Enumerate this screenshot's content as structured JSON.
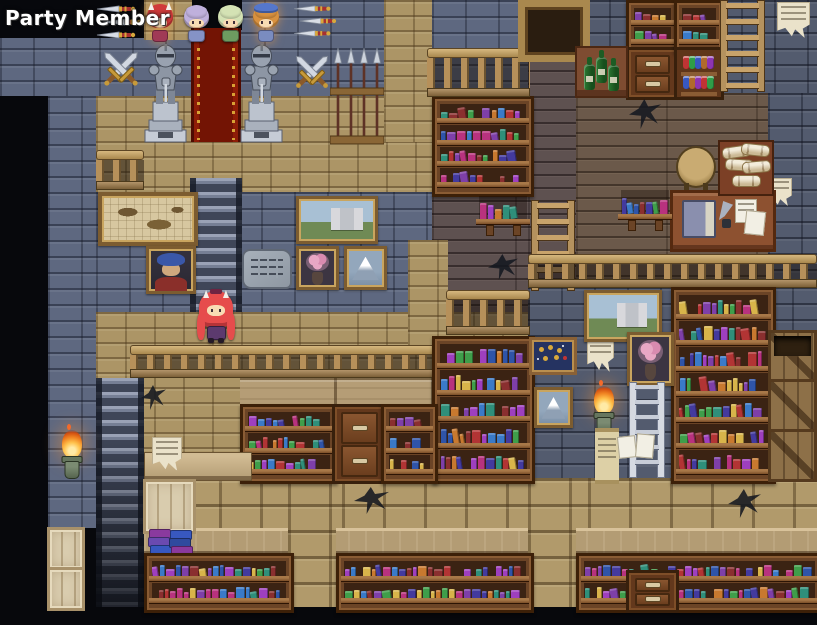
{
  "screen": {
    "width": 817,
    "height": 625
  },
  "hud": {
    "party_label": "Party Member"
  },
  "palette": {
    "books": [
      "#b23434",
      "#2f54a8",
      "#7e3fa8",
      "#2f8f7a",
      "#c8792f",
      "#b8327e",
      "#3a7ac8",
      "#8a2f2f",
      "#d8b44a",
      "#433a9e",
      "#3f9e4a",
      "#9e3fbe"
    ],
    "potions": [
      "#c03434",
      "#2f9e48",
      "#3858c0",
      "#b06a2c",
      "#8e34b0"
    ],
    "accent_gold": "#c79a3a",
    "carpet_red": "#8e1d07",
    "flame_orange": "#f08422",
    "stone_blue": "#5e6880",
    "stone_tan": "#ac9566",
    "wood_plank": "#5e5150",
    "wood_counter": "#b39c74"
  },
  "map": {
    "regions": [
      {
        "t": "blue",
        "x": 0,
        "y": 0,
        "w": 432,
        "h": 96
      },
      {
        "t": "blue",
        "x": 432,
        "y": 0,
        "w": 96,
        "h": 96
      },
      {
        "t": "blueD",
        "x": 576,
        "y": 0,
        "w": 241,
        "h": 93
      },
      {
        "t": "tan",
        "x": 144,
        "y": 0,
        "w": 48,
        "h": 40
      },
      {
        "t": "tan",
        "x": 96,
        "y": 96,
        "w": 336,
        "h": 96
      },
      {
        "t": "tan",
        "x": 384,
        "y": 0,
        "w": 48,
        "h": 142
      },
      {
        "t": "blue",
        "x": 96,
        "y": 192,
        "w": 336,
        "h": 120
      },
      {
        "t": "blue",
        "x": 48,
        "y": 96,
        "w": 48,
        "h": 432
      },
      {
        "t": "tan",
        "x": 96,
        "y": 312,
        "w": 432,
        "h": 166
      },
      {
        "t": "plank",
        "x": 432,
        "y": 96,
        "w": 96,
        "h": 216
      },
      {
        "t": "plank",
        "x": 528,
        "y": 44,
        "w": 48,
        "h": 268
      },
      {
        "t": "plankL",
        "x": 576,
        "y": 93,
        "w": 192,
        "h": 194
      },
      {
        "t": "blueD",
        "x": 768,
        "y": 93,
        "w": 49,
        "h": 194
      },
      {
        "t": "blueD",
        "x": 528,
        "y": 287,
        "w": 289,
        "h": 191
      },
      {
        "t": "tan",
        "x": 408,
        "y": 240,
        "w": 40,
        "h": 112
      },
      {
        "t": "tanblock",
        "x": 96,
        "y": 478,
        "w": 721,
        "h": 50
      },
      {
        "t": "counter",
        "x": 144,
        "y": 528,
        "w": 673,
        "h": 26
      },
      {
        "t": "tanblock",
        "x": 288,
        "y": 478,
        "w": 48,
        "h": 129
      },
      {
        "t": "tanblock",
        "x": 528,
        "y": 478,
        "w": 48,
        "h": 129
      },
      {
        "t": "panel",
        "x": 240,
        "y": 378,
        "w": 288,
        "h": 30
      },
      {
        "t": "black",
        "x": 192,
        "y": 0,
        "w": 50,
        "h": 30
      },
      {
        "t": "black",
        "x": 0,
        "y": 96,
        "w": 48,
        "h": 529
      },
      {
        "t": "black",
        "x": 0,
        "y": 607,
        "w": 817,
        "h": 18
      },
      {
        "t": "black",
        "x": 0,
        "y": 0,
        "w": 144,
        "h": 38
      }
    ],
    "objects": [
      {
        "t": "stairs",
        "n": "staircase-upper",
        "x": 190,
        "y": 178,
        "w": 52,
        "h": 134
      },
      {
        "t": "stairs",
        "n": "staircase-lower",
        "x": 96,
        "y": 378,
        "w": 48,
        "h": 229,
        "v": "fade"
      },
      {
        "t": "carpet",
        "n": "red-carpet",
        "x": 191,
        "y": 28,
        "w": 50,
        "h": 114
      },
      {
        "t": "swords",
        "n": "crossed-swords",
        "x": 97,
        "y": 46,
        "w": 48,
        "h": 46
      },
      {
        "t": "swords",
        "n": "crossed-swords",
        "x": 289,
        "y": 50,
        "w": 46,
        "h": 44
      },
      {
        "t": "daggers",
        "n": "throwing-knives",
        "x": 95,
        "y": 3,
        "w": 50,
        "h": 40
      },
      {
        "t": "daggers",
        "n": "throwing-knives",
        "x": 292,
        "y": 3,
        "w": 48,
        "h": 38
      },
      {
        "t": "statue",
        "n": "armor-statue",
        "x": 141,
        "y": 40,
        "w": 49,
        "h": 104
      },
      {
        "t": "statue",
        "n": "armor-statue",
        "x": 237,
        "y": 40,
        "w": 49,
        "h": 104
      },
      {
        "t": "spears",
        "n": "spear-rack",
        "x": 330,
        "y": 46,
        "w": 54,
        "h": 100
      },
      {
        "t": "railing",
        "n": "mezzanine-railing",
        "x": 96,
        "y": 150,
        "w": 48,
        "h": 40
      },
      {
        "t": "painting",
        "v": "map",
        "n": "wall-map",
        "x": 98,
        "y": 192,
        "w": 92,
        "h": 46
      },
      {
        "t": "painting",
        "v": "portrait",
        "n": "portrait-painting",
        "x": 146,
        "y": 246,
        "w": 44,
        "h": 42
      },
      {
        "t": "painting",
        "v": "castle",
        "n": "castle-painting",
        "x": 296,
        "y": 196,
        "w": 76,
        "h": 42
      },
      {
        "t": "tablet",
        "n": "stone-tablet",
        "x": 242,
        "y": 249,
        "w": 46,
        "h": 36
      },
      {
        "t": "painting",
        "v": "flowers",
        "n": "flower-painting",
        "x": 296,
        "y": 246,
        "w": 37,
        "h": 38
      },
      {
        "t": "painting",
        "v": "mountain",
        "n": "mountain-painting",
        "x": 344,
        "y": 246,
        "w": 37,
        "h": 38
      },
      {
        "t": "railing",
        "n": "balcony-railing",
        "x": 130,
        "y": 345,
        "w": 320,
        "h": 33
      },
      {
        "t": "bookshelf",
        "n": "bookshelf",
        "x": 432,
        "y": 96,
        "w": 96,
        "h": 95,
        "r": 4
      },
      {
        "t": "railing",
        "n": "balustrade",
        "x": 427,
        "y": 48,
        "w": 103,
        "h": 49
      },
      {
        "t": "frame",
        "n": "wooden-frame",
        "x": 518,
        "y": 0,
        "w": 58,
        "h": 48
      },
      {
        "t": "wallshelf",
        "n": "wall-shelf",
        "x": 478,
        "y": 196,
        "w": 50,
        "h": 40
      },
      {
        "t": "ladder",
        "n": "wooden-ladder",
        "x": 530,
        "y": 200,
        "w": 46,
        "h": 91,
        "v": "wood"
      },
      {
        "t": "crack",
        "n": "wall-crack",
        "x": 488,
        "y": 254,
        "w": 30,
        "h": 26
      },
      {
        "t": "railing",
        "n": "balustrade",
        "x": 446,
        "y": 290,
        "w": 84,
        "h": 45
      },
      {
        "t": "bookshelf",
        "n": "tall-bookshelf",
        "x": 432,
        "y": 336,
        "w": 97,
        "h": 142,
        "r": 5
      },
      {
        "t": "displaycase",
        "n": "display-case",
        "x": 529,
        "y": 337,
        "w": 42,
        "h": 32
      },
      {
        "t": "painting",
        "v": "mountain",
        "n": "mountain-painting",
        "x": 534,
        "y": 387,
        "w": 33,
        "h": 35
      },
      {
        "t": "poster",
        "n": "torn-poster",
        "x": 587,
        "y": 334,
        "w": 27,
        "h": 38
      },
      {
        "t": "bookshelf",
        "n": "bookshelf",
        "x": 626,
        "y": 0,
        "w": 47,
        "h": 48,
        "r": 2
      },
      {
        "t": "drawers",
        "n": "drawer-cabinet",
        "x": 626,
        "y": 47,
        "w": 47,
        "h": 47
      },
      {
        "t": "bookshelf",
        "n": "bookshelf",
        "x": 674,
        "y": 0,
        "w": 44,
        "h": 48,
        "r": 2
      },
      {
        "t": "potions",
        "n": "potion-shelf",
        "x": 674,
        "y": 47,
        "w": 44,
        "h": 47
      },
      {
        "t": "ladder",
        "n": "wooden-ladder",
        "x": 719,
        "y": 0,
        "w": 47,
        "h": 92,
        "v": "wood"
      },
      {
        "t": "winetable",
        "n": "wine-table",
        "x": 575,
        "y": 46,
        "w": 49,
        "h": 48
      },
      {
        "t": "poster",
        "n": "torn-poster",
        "x": 777,
        "y": 2,
        "w": 33,
        "h": 36
      },
      {
        "t": "crack",
        "n": "wall-crack",
        "x": 629,
        "y": 99,
        "w": 32,
        "h": 30
      },
      {
        "t": "poster",
        "n": "paper-scrap",
        "x": 766,
        "y": 178,
        "w": 26,
        "h": 28
      },
      {
        "t": "stool",
        "n": "stool",
        "x": 676,
        "y": 146,
        "w": 36,
        "h": 38
      },
      {
        "t": "desk",
        "n": "writing-desk",
        "x": 670,
        "y": 190,
        "w": 100,
        "h": 56
      },
      {
        "t": "scrolls",
        "n": "scroll-pile",
        "x": 718,
        "y": 140,
        "w": 52,
        "h": 52
      },
      {
        "t": "wallshelf",
        "n": "wall-shelf",
        "x": 620,
        "y": 190,
        "w": 50,
        "h": 42
      },
      {
        "t": "railing",
        "n": "balcony-railing",
        "x": 528,
        "y": 254,
        "w": 289,
        "h": 34
      },
      {
        "t": "painting",
        "v": "castle",
        "n": "castle-painting",
        "x": 584,
        "y": 290,
        "w": 72,
        "h": 46
      },
      {
        "t": "bookshelf",
        "n": "tall-bookshelf",
        "x": 671,
        "y": 287,
        "w": 99,
        "h": 191,
        "r": 7
      },
      {
        "t": "painting",
        "v": "flowers",
        "n": "flower-painting",
        "x": 627,
        "y": 332,
        "w": 41,
        "h": 48
      },
      {
        "t": "ladder",
        "n": "metal-ladder",
        "x": 628,
        "y": 382,
        "w": 38,
        "h": 96,
        "v": "metal"
      },
      {
        "t": "torch",
        "n": "wall-torch",
        "x": 586,
        "y": 386,
        "w": 36,
        "h": 52
      },
      {
        "t": "scrollposter",
        "n": "notice-scroll",
        "x": 595,
        "y": 428,
        "w": 24,
        "h": 48
      },
      {
        "t": "papers",
        "n": "pinned-papers",
        "x": 618,
        "y": 434,
        "w": 36,
        "h": 28
      },
      {
        "t": "crates",
        "n": "crate-stack",
        "x": 768,
        "y": 330,
        "w": 49,
        "h": 148,
        "v": "dark",
        "b": 3
      },
      {
        "t": "bookshelf",
        "n": "bookshelf",
        "x": 240,
        "y": 404,
        "w": 92,
        "h": 74,
        "r": 3
      },
      {
        "t": "drawers",
        "n": "drawer-cabinet",
        "x": 332,
        "y": 404,
        "w": 49,
        "h": 74
      },
      {
        "t": "bookshelf",
        "n": "bookshelf",
        "x": 381,
        "y": 404,
        "w": 51,
        "h": 74,
        "r": 3
      },
      {
        "t": "counterpiece",
        "n": "wall-counter",
        "x": 144,
        "y": 452,
        "w": 106,
        "h": 27
      },
      {
        "t": "crate",
        "n": "crate",
        "x": 143,
        "y": 479,
        "w": 47,
        "h": 49,
        "v": "pale"
      },
      {
        "t": "poster",
        "n": "paper-scrap",
        "x": 152,
        "y": 437,
        "w": 30,
        "h": 34
      },
      {
        "t": "crack",
        "n": "wall-crack",
        "x": 141,
        "y": 385,
        "w": 25,
        "h": 25
      },
      {
        "t": "crack",
        "n": "wall-crack",
        "x": 354,
        "y": 487,
        "w": 35,
        "h": 27
      },
      {
        "t": "crack",
        "n": "wall-crack",
        "x": 728,
        "y": 489,
        "w": 33,
        "h": 29
      },
      {
        "t": "bookstack",
        "n": "book-stack",
        "x": 147,
        "y": 526,
        "w": 44,
        "h": 28
      },
      {
        "t": "bookshelf",
        "n": "bookshelf",
        "x": 144,
        "y": 553,
        "w": 144,
        "h": 54,
        "r": 2
      },
      {
        "t": "bookshelf",
        "n": "bookshelf",
        "x": 336,
        "y": 553,
        "w": 192,
        "h": 54,
        "r": 2
      },
      {
        "t": "bookshelf",
        "n": "bookshelf",
        "x": 576,
        "y": 553,
        "w": 241,
        "h": 54,
        "r": 2
      },
      {
        "t": "drawers",
        "n": "drawer-cabinet",
        "x": 626,
        "y": 570,
        "w": 47,
        "h": 37
      },
      {
        "t": "crates",
        "n": "crate-stack",
        "x": 47,
        "y": 527,
        "w": 38,
        "h": 80,
        "v": "pale",
        "b": 2
      },
      {
        "t": "torch",
        "n": "wall-torch",
        "x": 54,
        "y": 430,
        "w": 36,
        "h": 52
      },
      {
        "t": "sprite",
        "n": "party-member-1",
        "x": 146,
        "y": 2,
        "w": 28,
        "h": 40,
        "hair": "#d03a3a",
        "outfit": "#a03a56",
        "horns": true,
        "glow": true
      },
      {
        "t": "sprite",
        "n": "party-member-2",
        "x": 183,
        "y": 3,
        "w": 27,
        "h": 39,
        "hair": "#bfb0dc",
        "outfit": "#8593c6"
      },
      {
        "t": "sprite",
        "n": "party-member-3",
        "x": 217,
        "y": 3,
        "w": 27,
        "h": 39,
        "hair": "#d4e2b4",
        "outfit": "#6d9c60"
      },
      {
        "t": "sprite",
        "n": "party-member-4",
        "x": 252,
        "y": 3,
        "w": 28,
        "h": 39,
        "hair": "#d8913f",
        "outfit": "#7a8cc0",
        "hat": "#5577cc",
        "glow": true
      },
      {
        "t": "playersprite",
        "n": "player-character",
        "x": 197,
        "y": 290,
        "w": 38,
        "h": 54,
        "hair": "#e64c4c",
        "outfit": "#5c3a6e"
      }
    ]
  }
}
